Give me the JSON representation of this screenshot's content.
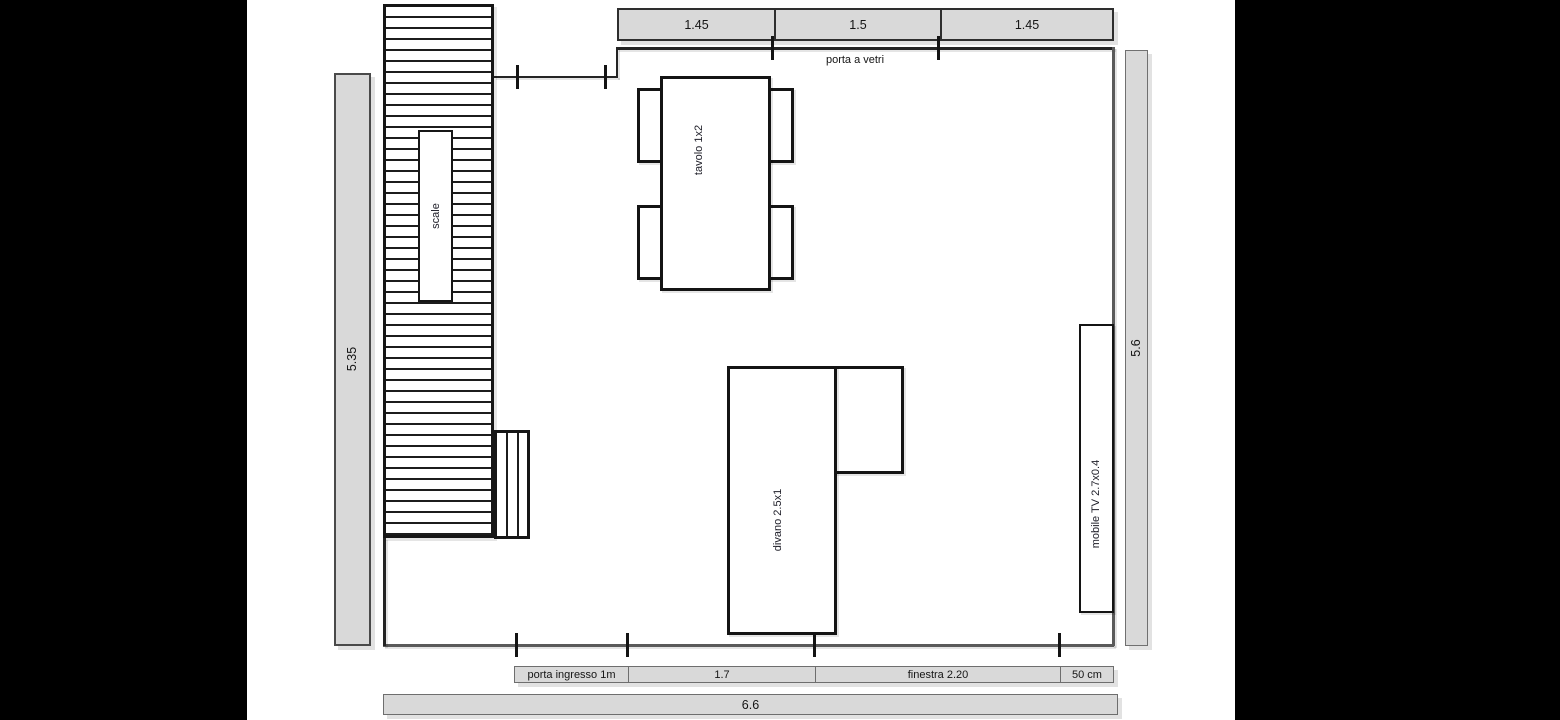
{
  "diagram": "floor-plan",
  "colors": {
    "background": "#000000",
    "page": "#ffffff",
    "dimension_fill": "#d9d9d9",
    "line": "#1c1c1c"
  },
  "top_dimensions": {
    "cells": [
      {
        "label": "1.45"
      },
      {
        "label": "1.5"
      },
      {
        "label": "1.45"
      }
    ]
  },
  "room": {
    "glass_door_label": "porta a vetri",
    "stairs_label": "scale",
    "table_label": "tavolo 1x2",
    "sofa_label": "divano 2.5x1",
    "tv_label": "mobile TV 2.7x0.4"
  },
  "side_dimensions": {
    "left_height": "5.35",
    "right_height": "5.6"
  },
  "bottom_dimensions": {
    "cells": [
      {
        "label": "porta ingresso 1m"
      },
      {
        "label": "1.7"
      },
      {
        "label": "finestra 2.20"
      },
      {
        "label": "50 cm"
      }
    ],
    "total_width": "6.6"
  }
}
